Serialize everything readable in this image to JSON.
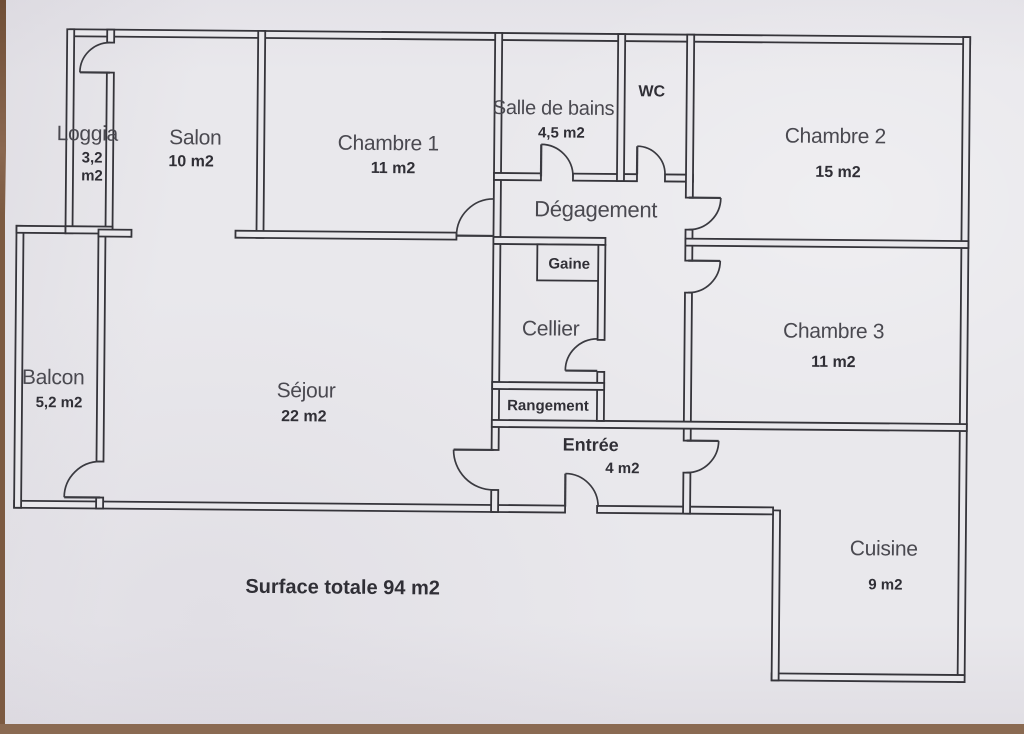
{
  "document": {
    "type": "floor-plan",
    "language": "fr",
    "summary": "Surface totale 94 m2"
  },
  "colors": {
    "paper": "#e9e8ec",
    "line": "#35343a",
    "text": "#4a4950",
    "backdrop_wood": "#7c5a41"
  },
  "rooms": {
    "loggia": {
      "name": "Loggia",
      "area_line1": "3,2",
      "area_line2": "m2"
    },
    "salon": {
      "name": "Salon",
      "area": "10 m2"
    },
    "chambre1": {
      "name": "Chambre 1",
      "area": "11 m2"
    },
    "salle_bains": {
      "name": "Salle de bains",
      "area": "4,5 m2"
    },
    "wc": {
      "name": "WC"
    },
    "chambre2": {
      "name": "Chambre 2",
      "area": "15 m2"
    },
    "degagement": {
      "name": "Dégagement"
    },
    "gaine": {
      "name": "Gaine"
    },
    "cellier": {
      "name": "Cellier"
    },
    "chambre3": {
      "name": "Chambre 3",
      "area": "11 m2"
    },
    "balcon": {
      "name": "Balcon",
      "area": "5,2 m2"
    },
    "sejour": {
      "name": "Séjour",
      "area": "22 m2"
    },
    "rangement": {
      "name": "Rangement"
    },
    "entree": {
      "name": "Entrée",
      "area": "4 m2"
    },
    "cuisine": {
      "name": "Cuisine",
      "area": "9 m2"
    }
  }
}
